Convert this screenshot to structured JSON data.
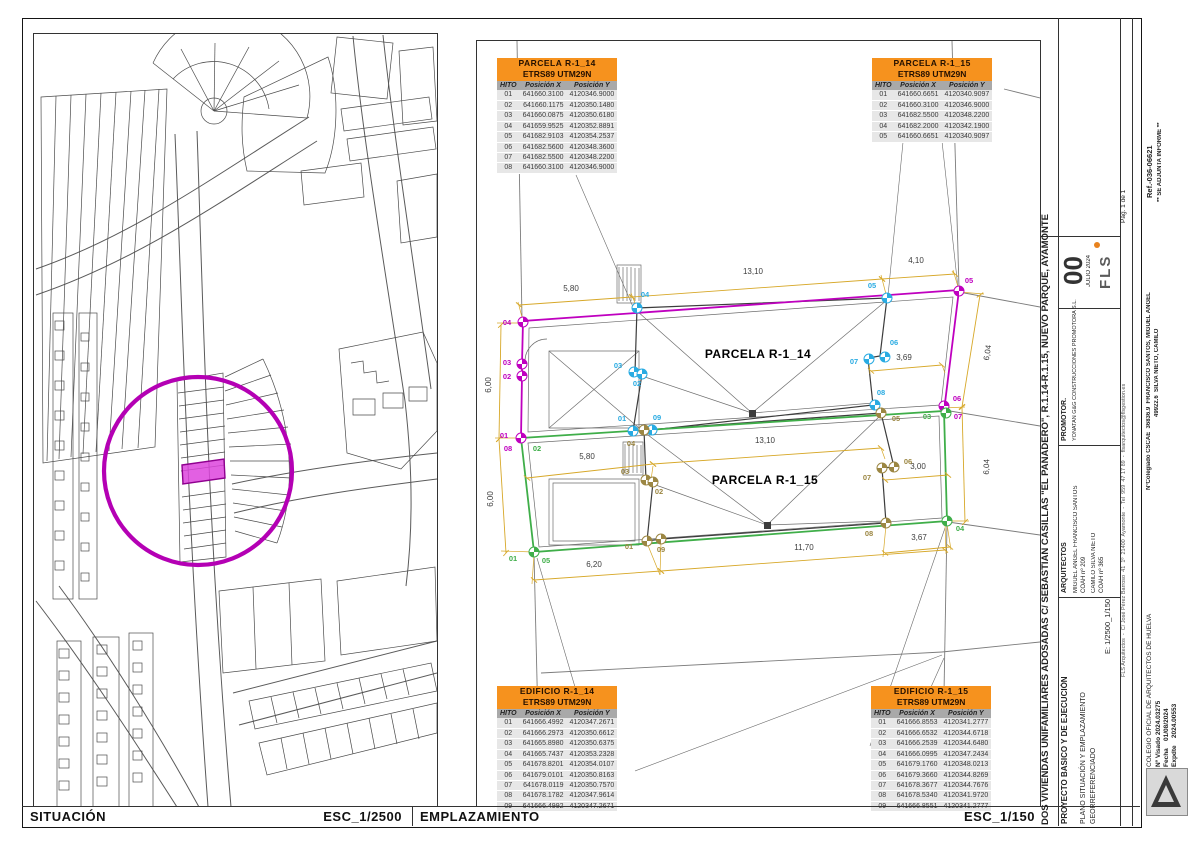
{
  "footer": {
    "situacion": "SITUACIÓN",
    "esc_situacion": "ESC_1/2500",
    "emplazamiento": "EMPLAZAMIENTO",
    "esc_emplazamiento": "ESC_1/150"
  },
  "tables": [
    {
      "id": "parcela-r1-14",
      "title": "PARCELA  R-1_14",
      "subtitle": "ETRS89 UTM29N",
      "columns": [
        "HITO",
        "Posición X",
        "Posición Y"
      ],
      "rows": [
        [
          "01",
          "641660.3100",
          "4120346.9000"
        ],
        [
          "02",
          "641660.1175",
          "4120350.1480"
        ],
        [
          "03",
          "641660.0875",
          "4120350.6180"
        ],
        [
          "04",
          "641659.9525",
          "4120352.8891"
        ],
        [
          "05",
          "641682.9103",
          "4120354.2537"
        ],
        [
          "06",
          "641682.5600",
          "4120348.3600"
        ],
        [
          "07",
          "641682.5500",
          "4120348.2200"
        ],
        [
          "08",
          "641660.3100",
          "4120346.9000"
        ]
      ]
    },
    {
      "id": "parcela-r1-15",
      "title": "PARCELA  R-1_15",
      "subtitle": "ETRS89 UTM29N",
      "columns": [
        "HITO",
        "Posición X",
        "Posición Y"
      ],
      "rows": [
        [
          "01",
          "641660.6651",
          "4120340.9097"
        ],
        [
          "02",
          "641660.3100",
          "4120346.9000"
        ],
        [
          "03",
          "641682.5500",
          "4120348.2200"
        ],
        [
          "04",
          "641682.2000",
          "4120342.1900"
        ],
        [
          "05",
          "641660.6651",
          "4120340.9097"
        ]
      ]
    },
    {
      "id": "edificio-r1-14",
      "title": "EDIFICIO  R-1_14",
      "subtitle": "ETRS89 UTM29N",
      "columns": [
        "HITO",
        "Posición X",
        "Posición Y"
      ],
      "rows": [
        [
          "01",
          "641666.4992",
          "4120347.2671"
        ],
        [
          "02",
          "641666.2973",
          "4120350.6612"
        ],
        [
          "03",
          "641665.8980",
          "4120350.6375"
        ],
        [
          "04",
          "641665.7437",
          "4120353.2328"
        ],
        [
          "05",
          "641678.8201",
          "4120354.0107"
        ],
        [
          "06",
          "641679.0101",
          "4120350.8163"
        ],
        [
          "07",
          "641678.0119",
          "4120350.7570"
        ],
        [
          "08",
          "641678.1782",
          "4120347.9614"
        ],
        [
          "09",
          "641666.4992",
          "4120347.2671"
        ]
      ]
    },
    {
      "id": "edificio-r1-15",
      "title": "EDIFICIO  R-1_15",
      "subtitle": "ETRS89 UTM29N",
      "columns": [
        "HITO",
        "Posición X",
        "Posición Y"
      ],
      "rows": [
        [
          "01",
          "641666.8553",
          "4120341.2777"
        ],
        [
          "02",
          "641666.6532",
          "4120344.6718"
        ],
        [
          "03",
          "641666.2539",
          "4120344.6480"
        ],
        [
          "04",
          "641666.0995",
          "4120347.2434"
        ],
        [
          "05",
          "641679.1760",
          "4120348.0213"
        ],
        [
          "06",
          "641679.3660",
          "4120344.8269"
        ],
        [
          "07",
          "641678.3677",
          "4120344.7676"
        ],
        [
          "08",
          "641678.5340",
          "4120341.9720"
        ],
        [
          "09",
          "641666.8551",
          "4120341.2777"
        ]
      ]
    }
  ],
  "titleblock": {
    "project_title": "DOS VIVIENDAS UNIFAMILIARES ADOSADAS C/ SEBASTIAN CASILLAS \"EL PANADERO\", R.1.14-R.1.15, NUEVO PARQUE, AYAMONTE",
    "phase": "PROYECTO BASICO Y DE EJECUCIÓN",
    "plano_line1": "PLANO SITUACIÓN Y EMPLAZAMIENTO",
    "plano_line2": "GEORREFERENCIADO",
    "escala": "E: 1/2500_1/150",
    "arquitectos_label": "ARQUITECTOS",
    "arquitecto1": "MIGUEL ANGEL FRANCISCO SANTOS",
    "arquitecto1_coah": "COAH nº 209",
    "arquitecto2": "CAMILO SILVA NIETO",
    "arquitecto2_coah": "COAH nº 365",
    "promotor_label": "PROMOTOR.",
    "promotor": "YONATAN G&G CONSTRUCCIONES PROMOTORA S.L.",
    "revision": "00",
    "revision_date": "JULIO 2024",
    "logo_text": "FLS",
    "firm_line": "FLS Arquitectos  -  C/ José Pérez Barroso  41  1º  21400  Ayamonte  -  Tel  959  47 17 89  -  flsarquitectos@flsgestion.es",
    "colegiado_line1": "NºColegiado CSCAE  36836.9  FRANCISCO SANTOS, MIGUEL ANGEL",
    "colegiado_line2": "49922.6  SILVA NIETO, CAMILO",
    "page": "Pág. 1 de 1"
  },
  "stamps": {
    "ref": "Ref.-036-06621",
    "informe": "** SE ADJUNTA INFORME **",
    "colegio": "COLEGIO OFICIAL DE ARQUITECTOS DE HUELVA",
    "visado": "Nº Visado 2024.03275",
    "fecha": "Fecha    01/08/2024",
    "expdte": "Expdte    2024.00553"
  },
  "plan": {
    "context": [
      "516,40 521,318",
      "951,40 958,287",
      "958,291 1039,306",
      "943,409 1039,425",
      "947,521 1039,534",
      "533,553 539,805",
      "946,523 941,805",
      "540,672 941,651",
      "941,651 1039,641",
      "1003,88 1039,97"
    ],
    "leaders": [
      "575,174 632,306",
      "940,131 957,287",
      "903,131 887,295",
      "574,686 536,557",
      "930,686 943,657",
      "634,770 941,654",
      "869,745 944,527"
    ],
    "details": [
      {
        "p": "527,431 528,327 952,296 940,404",
        "closed": true
      },
      {
        "p": "527,442 938,415 941,517 538,546",
        "closed": true
      },
      {
        "p": "548,350 638,350 638,427 548,427",
        "closed": true
      },
      {
        "p": "548,478 638,478 638,544 548,544",
        "closed": true
      },
      {
        "p": "552,482 634,482 634,540 552,540",
        "closed": true
      },
      {
        "p": "616,264 640,264 640,302 616,302",
        "closed": true
      },
      {
        "p": "622,441 642,441 642,474 622,474",
        "closed": true
      }
    ],
    "lines": [
      "618,266 618,300",
      "622,266 622,300",
      "626,266 626,300",
      "630,266 630,300",
      "634,267 634,300",
      "638,267 638,300",
      "624,443 624,472",
      "628,443 628,472",
      "632,443 632,472",
      "636,444 636,472",
      "640,444 640,472",
      "636,310 751,412",
      "886,299 751,412",
      "641,375 751,412",
      "872,402 751,412",
      "643,431 766,524",
      "880,414 766,524",
      "652,483 766,524",
      "885,520 766,524",
      "548,350 638,427",
      "638,350 548,427"
    ],
    "arcs": [
      "M524,360 A22,22 0 0 1 546,338"
    ],
    "squares": [
      [
        748,
        409
      ],
      [
        763,
        521
      ]
    ],
    "buildings": [
      "632,430 641,373 634,371 636,307 886,297 879,355 867,357 872,404 651,429",
      "646,540 652,481 645,479 643,429 880,412 893,466 881,467 885,522 660,538"
    ],
    "parcels": [
      {
        "p": "520,437 521,375 521,363 522,320 958,289 943,410",
        "c": "#bf00bf",
        "closed": false
      },
      {
        "p": "520,437 943,410 946,520 533,551",
        "c": "#3fae49",
        "closed": true
      }
    ],
    "gext": [
      "522,320 517,301",
      "636,307 630,292",
      "886,297 880,274",
      "958,289 952,269",
      "522,322 496,322",
      "520,437 494,437",
      "533,551 500,550",
      "958,291 983,293",
      "943,407 964,406",
      "946,520 968,520",
      "533,553 531,583",
      "646,542 659,574",
      "885,524 882,556",
      "946,523 950,549",
      "868,360 869,373",
      "941,364 944,372",
      "652,465 650,479",
      "880,447 884,458",
      "660,540 659,574",
      "944,522 945,553"
    ],
    "dims": [
      {
        "x1": 518,
        "y1": 304,
        "x2": 631,
        "y2": 296,
        "t": "5,80",
        "tx": 570,
        "ty": 290
      },
      {
        "x1": 631,
        "y1": 296,
        "x2": 881,
        "y2": 278,
        "t": "13,10",
        "tx": 752,
        "ty": 273
      },
      {
        "x1": 881,
        "y1": 278,
        "x2": 954,
        "y2": 273,
        "t": "4,10",
        "tx": 915,
        "ty": 262
      },
      {
        "x1": 500,
        "y1": 324,
        "x2": 498,
        "y2": 438,
        "t": "6,00",
        "tx": 490,
        "ty": 384,
        "rot": -90
      },
      {
        "x1": 498,
        "y1": 438,
        "x2": 505,
        "y2": 552,
        "t": "6,00",
        "tx": 492,
        "ty": 498,
        "rot": -90
      },
      {
        "x1": 979,
        "y1": 294,
        "x2": 961,
        "y2": 406,
        "t": "6,04",
        "tx": 989,
        "ty": 352,
        "rot": -81
      },
      {
        "x1": 961,
        "y1": 406,
        "x2": 964,
        "y2": 521,
        "t": "6,04",
        "tx": 988,
        "ty": 466,
        "rot": -88
      },
      {
        "x1": 870,
        "y1": 370,
        "x2": 941,
        "y2": 364,
        "t": "3,69",
        "tx": 903,
        "ty": 359
      },
      {
        "x1": 652,
        "y1": 463,
        "x2": 880,
        "y2": 447,
        "t": "13,10",
        "tx": 764,
        "ty": 442
      },
      {
        "x1": 526,
        "y1": 477,
        "x2": 652,
        "y2": 463,
        "t": "5,80",
        "tx": 586,
        "ty": 458
      },
      {
        "x1": 884,
        "y1": 479,
        "x2": 947,
        "y2": 474,
        "t": "3,00",
        "tx": 917,
        "ty": 468
      },
      {
        "x1": 884,
        "y1": 552,
        "x2": 949,
        "y2": 546,
        "t": "3,67",
        "tx": 918,
        "ty": 539
      },
      {
        "x1": 660,
        "y1": 570,
        "x2": 944,
        "y2": 549,
        "t": "11,70",
        "tx": 803,
        "ty": 549
      },
      {
        "x1": 533,
        "y1": 579,
        "x2": 660,
        "y2": 570,
        "t": "6,20",
        "tx": 593,
        "ty": 566
      }
    ],
    "hitos": [
      {
        "x": 522,
        "y": 321,
        "c": "#bf00bf"
      },
      {
        "x": 521,
        "y": 363,
        "c": "#bf00bf"
      },
      {
        "x": 521,
        "y": 375,
        "c": "#bf00bf"
      },
      {
        "x": 520,
        "y": 437,
        "c": "#bf00bf"
      },
      {
        "x": 958,
        "y": 290,
        "c": "#bf00bf"
      },
      {
        "x": 943,
        "y": 405,
        "c": "#bf00bf"
      },
      {
        "x": 945,
        "y": 412,
        "c": "#3fae49"
      },
      {
        "x": 533,
        "y": 551,
        "c": "#3fae49"
      },
      {
        "x": 946,
        "y": 520,
        "c": "#3fae49"
      },
      {
        "x": 636,
        "y": 307,
        "c": "#29abe2"
      },
      {
        "x": 633,
        "y": 371,
        "c": "#29abe2"
      },
      {
        "x": 641,
        "y": 373,
        "c": "#29abe2"
      },
      {
        "x": 632,
        "y": 430,
        "c": "#29abe2"
      },
      {
        "x": 651,
        "y": 429,
        "c": "#29abe2"
      },
      {
        "x": 886,
        "y": 297,
        "c": "#29abe2"
      },
      {
        "x": 884,
        "y": 356,
        "c": "#29abe2"
      },
      {
        "x": 868,
        "y": 358,
        "c": "#29abe2"
      },
      {
        "x": 874,
        "y": 404,
        "c": "#29abe2"
      },
      {
        "x": 643,
        "y": 429,
        "c": "#9c8743"
      },
      {
        "x": 645,
        "y": 479,
        "c": "#9c8743"
      },
      {
        "x": 652,
        "y": 481,
        "c": "#9c8743"
      },
      {
        "x": 646,
        "y": 540,
        "c": "#9c8743"
      },
      {
        "x": 660,
        "y": 538,
        "c": "#9c8743"
      },
      {
        "x": 880,
        "y": 412,
        "c": "#9c8743"
      },
      {
        "x": 893,
        "y": 466,
        "c": "#9c8743"
      },
      {
        "x": 881,
        "y": 467,
        "c": "#9c8743"
      },
      {
        "x": 885,
        "y": 522,
        "c": "#9c8743"
      }
    ],
    "hito_labels": [
      {
        "t": "04",
        "x": 506,
        "y": 324,
        "c": "#bf00bf"
      },
      {
        "t": "03",
        "x": 506,
        "y": 364,
        "c": "#bf00bf"
      },
      {
        "t": "02",
        "x": 506,
        "y": 378,
        "c": "#bf00bf"
      },
      {
        "t": "01",
        "x": 503,
        "y": 437,
        "c": "#bf00bf"
      },
      {
        "t": "08",
        "x": 507,
        "y": 450,
        "c": "#bf00bf"
      },
      {
        "t": "05",
        "x": 968,
        "y": 282,
        "c": "#bf00bf"
      },
      {
        "t": "06",
        "x": 956,
        "y": 400,
        "c": "#bf00bf"
      },
      {
        "t": "07",
        "x": 957,
        "y": 418,
        "c": "#bf00bf"
      },
      {
        "t": "02",
        "x": 536,
        "y": 450,
        "c": "#3fae49"
      },
      {
        "t": "03",
        "x": 926,
        "y": 418,
        "c": "#3fae49"
      },
      {
        "t": "04",
        "x": 959,
        "y": 530,
        "c": "#3fae49"
      },
      {
        "t": "01",
        "x": 512,
        "y": 560,
        "c": "#3fae49"
      },
      {
        "t": "05",
        "x": 545,
        "y": 562,
        "c": "#3fae49"
      },
      {
        "t": "04",
        "x": 644,
        "y": 296,
        "c": "#29abe2"
      },
      {
        "t": "03",
        "x": 617,
        "y": 367,
        "c": "#29abe2"
      },
      {
        "t": "02",
        "x": 636,
        "y": 385,
        "c": "#29abe2"
      },
      {
        "t": "01",
        "x": 621,
        "y": 420,
        "c": "#29abe2"
      },
      {
        "t": "09",
        "x": 656,
        "y": 419,
        "c": "#29abe2"
      },
      {
        "t": "05",
        "x": 871,
        "y": 287,
        "c": "#29abe2"
      },
      {
        "t": "06",
        "x": 893,
        "y": 344,
        "c": "#29abe2"
      },
      {
        "t": "07",
        "x": 853,
        "y": 363,
        "c": "#29abe2"
      },
      {
        "t": "08",
        "x": 880,
        "y": 394,
        "c": "#29abe2"
      },
      {
        "t": "04",
        "x": 630,
        "y": 445,
        "c": "#9c8743"
      },
      {
        "t": "03",
        "x": 624,
        "y": 473,
        "c": "#9c8743"
      },
      {
        "t": "02",
        "x": 658,
        "y": 493,
        "c": "#9c8743"
      },
      {
        "t": "01",
        "x": 628,
        "y": 548,
        "c": "#9c8743"
      },
      {
        "t": "09",
        "x": 660,
        "y": 551,
        "c": "#9c8743"
      },
      {
        "t": "05",
        "x": 895,
        "y": 420,
        "c": "#9c8743"
      },
      {
        "t": "06",
        "x": 907,
        "y": 463,
        "c": "#9c8743"
      },
      {
        "t": "07",
        "x": 866,
        "y": 479,
        "c": "#9c8743"
      },
      {
        "t": "08",
        "x": 868,
        "y": 535,
        "c": "#9c8743"
      }
    ],
    "labels": [
      {
        "t": "PARCELA R-1_14",
        "x": 757,
        "y": 357
      },
      {
        "t": "PARCELA R-1_15",
        "x": 764,
        "y": 483
      }
    ]
  }
}
